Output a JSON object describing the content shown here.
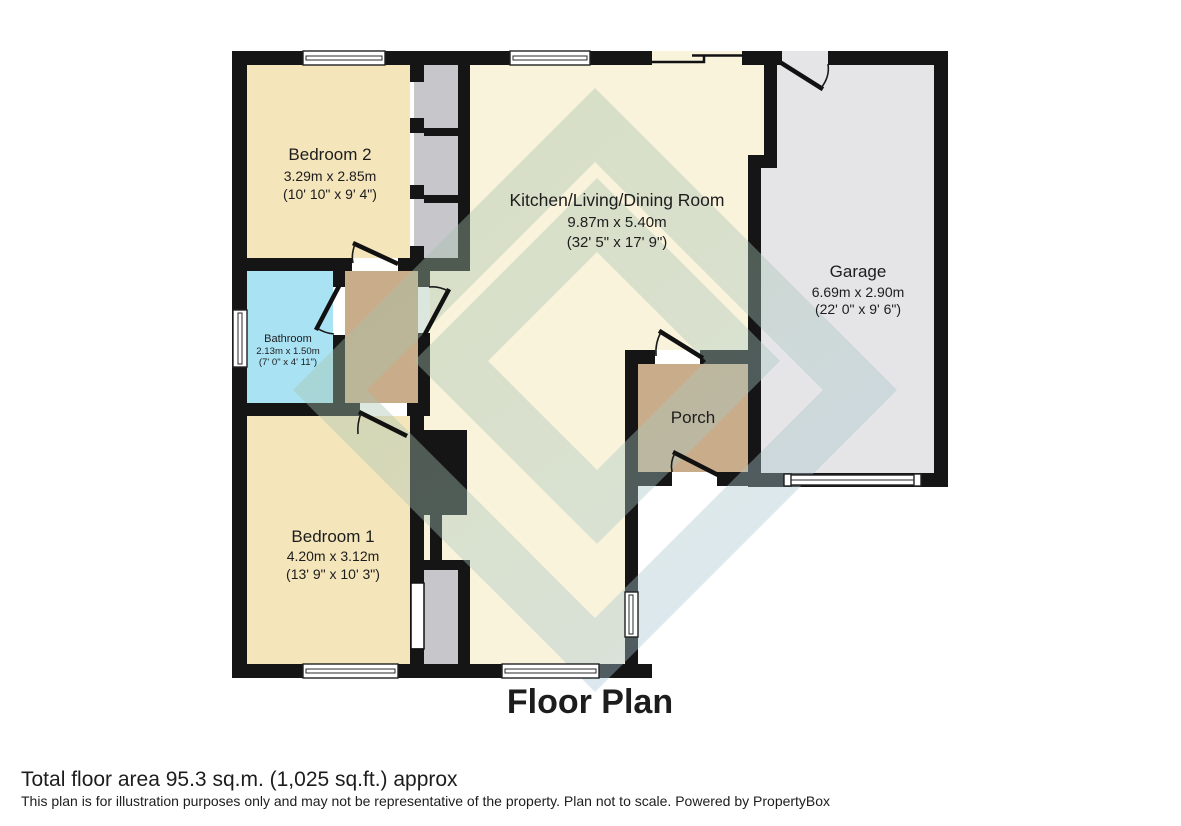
{
  "title": "Floor Plan",
  "footer": {
    "total_area": "Total floor area 95.3 sq.m. (1,025 sq.ft.) approx",
    "disclaimer": "This plan is for illustration purposes only and may not be representative of the property. Plan not to scale. Powered by PropertyBox"
  },
  "rooms": [
    {
      "name": "Bedroom 2",
      "dims_m": "3.29m x 2.85m",
      "dims_ft": "(10' 10\" x 9' 4\")"
    },
    {
      "name": "Kitchen/Living/Dining Room",
      "dims_m": "9.87m x 5.40m",
      "dims_ft": "(32' 5\" x 17' 9\")"
    },
    {
      "name": "Garage",
      "dims_m": "6.69m x 2.90m",
      "dims_ft": "(22' 0\" x 9' 6\")"
    },
    {
      "name": "Bathroom",
      "dims_m": "2.13m x 1.50m",
      "dims_ft": "(7' 0\" x 4' 11\")"
    },
    {
      "name": "Porch"
    },
    {
      "name": "Bedroom 1",
      "dims_m": "4.20m x 3.12m",
      "dims_ft": "(13' 9\" x 10' 3\")"
    }
  ],
  "colors": {
    "wall": "#151515",
    "bedroom": "#f4e5bb",
    "kitchen": "#f9f3dc",
    "bathroom": "#a9e2f3",
    "hall_porch": "#c9ad8a",
    "garage": "#e5e5e7",
    "closet": "#c6c6cb",
    "watermark_green": "#a3bfa0",
    "watermark_blue": "#a9c6e0"
  }
}
